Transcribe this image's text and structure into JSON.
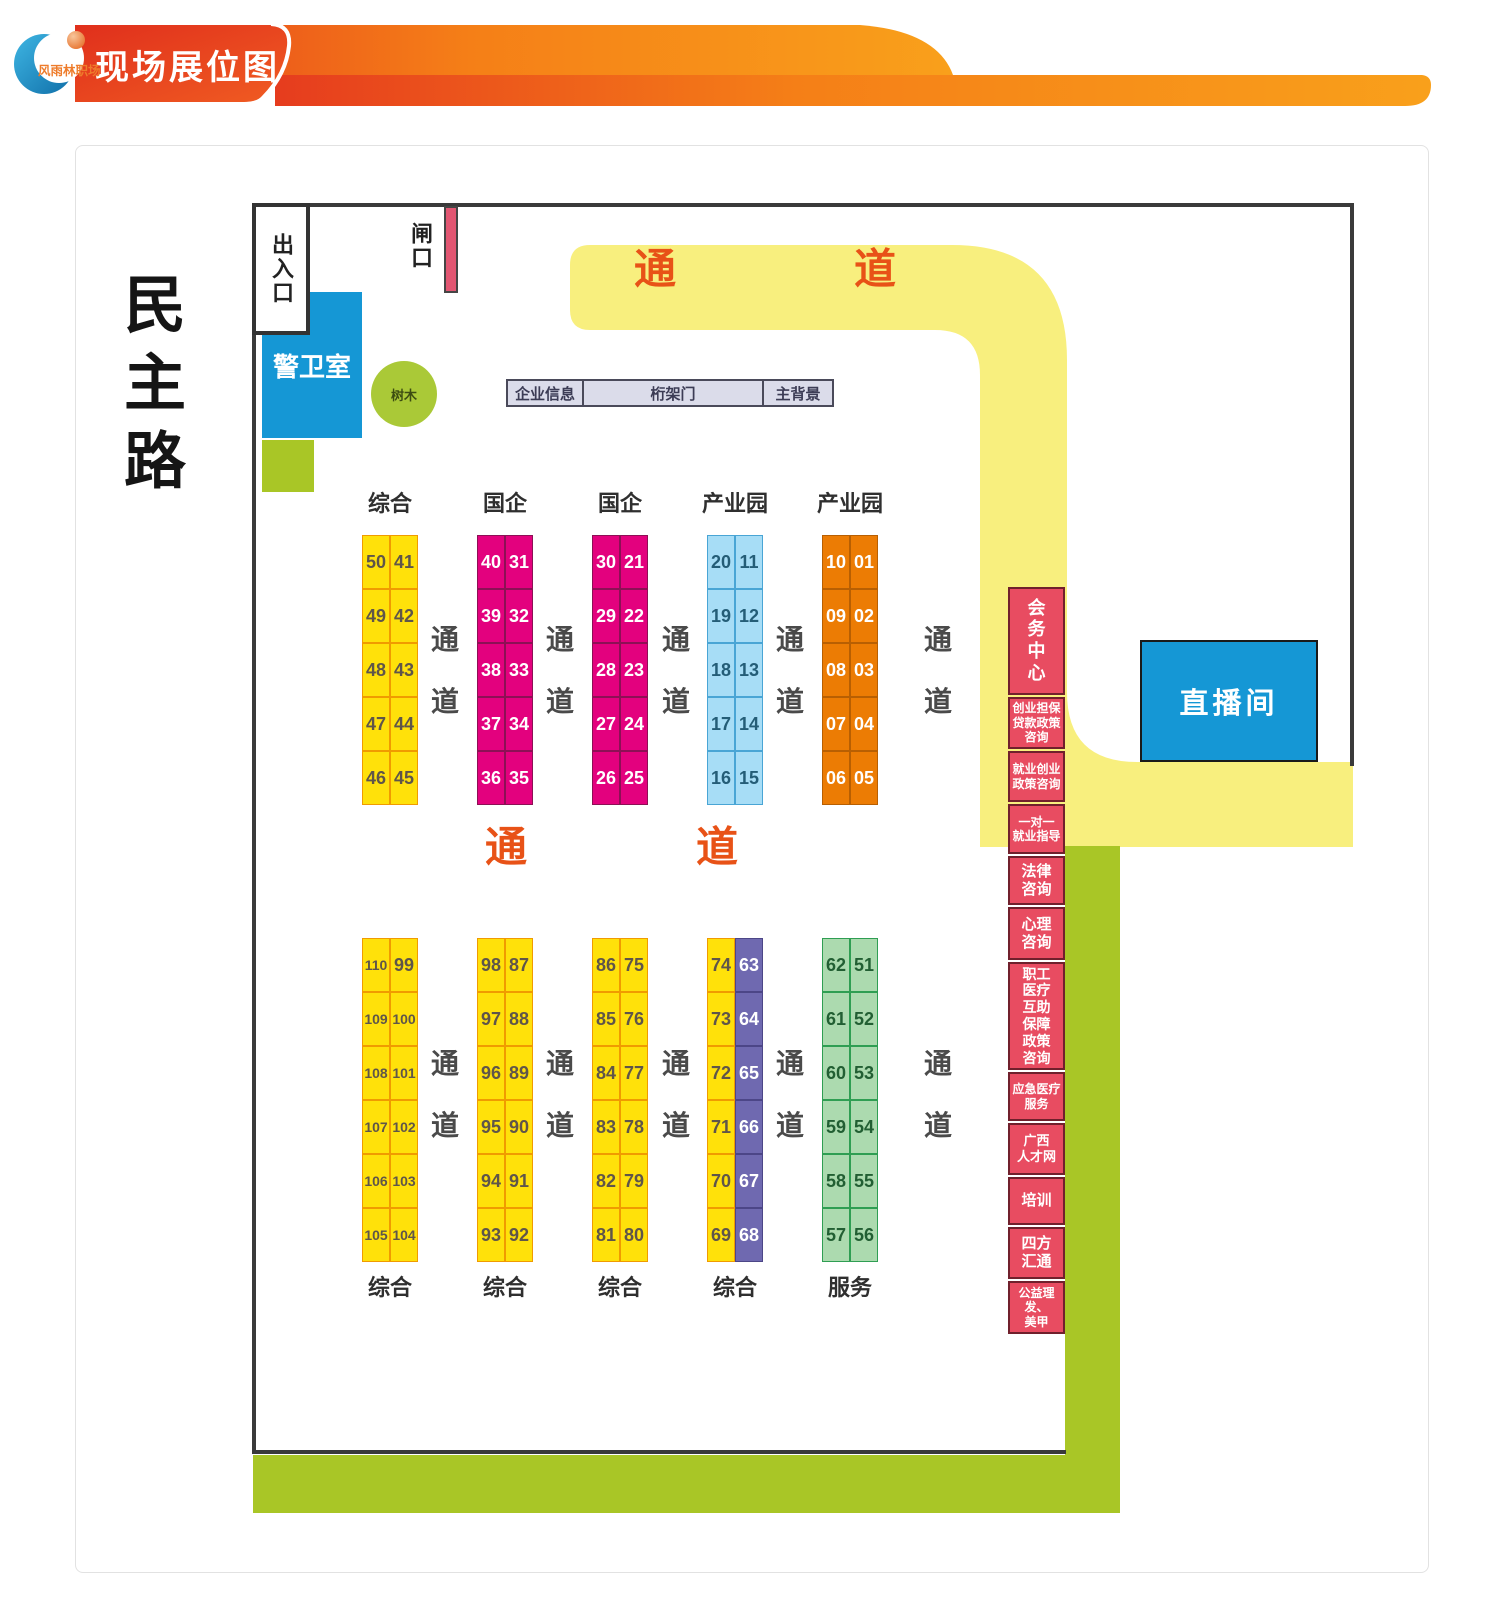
{
  "logo": {
    "text": "风雨林职场"
  },
  "header": {
    "title": "现场展位图"
  },
  "road_label": "民主路",
  "plan": {
    "entrance": "出入口",
    "gate": "闸口",
    "guard_room": "警卫室",
    "tree": "树木",
    "info_bar": [
      "企业信息",
      "桁架门",
      "主背景"
    ],
    "live_room": "直播间",
    "corridor_word": [
      "通",
      "道"
    ]
  },
  "top_section": {
    "groups": [
      {
        "label": "综合",
        "theme": "yellow",
        "left": [
          "50",
          "49",
          "48",
          "47",
          "46"
        ],
        "right": [
          "41",
          "42",
          "43",
          "44",
          "45"
        ]
      },
      {
        "label": "国企",
        "theme": "magenta",
        "left": [
          "40",
          "39",
          "38",
          "37",
          "36"
        ],
        "right": [
          "31",
          "32",
          "33",
          "34",
          "35"
        ]
      },
      {
        "label": "国企",
        "theme": "magenta",
        "left": [
          "30",
          "29",
          "28",
          "27",
          "26"
        ],
        "right": [
          "21",
          "22",
          "23",
          "24",
          "25"
        ]
      },
      {
        "label": "产业园",
        "theme": "blue",
        "left": [
          "20",
          "19",
          "18",
          "17",
          "16"
        ],
        "right": [
          "11",
          "12",
          "13",
          "14",
          "15"
        ]
      },
      {
        "label": "产业园",
        "theme": "orange",
        "left": [
          "10",
          "09",
          "08",
          "07",
          "06"
        ],
        "right": [
          "01",
          "02",
          "03",
          "04",
          "05"
        ]
      }
    ]
  },
  "bottom_section": {
    "groups": [
      {
        "label": "综合",
        "theme": "yellow",
        "left": [
          "110",
          "109",
          "108",
          "107",
          "106",
          "105"
        ],
        "right": [
          "99",
          "100",
          "101",
          "102",
          "103",
          "104"
        ]
      },
      {
        "label": "综合",
        "theme": "yellow",
        "left": [
          "98",
          "97",
          "96",
          "95",
          "94",
          "93"
        ],
        "right": [
          "87",
          "88",
          "89",
          "90",
          "91",
          "92"
        ]
      },
      {
        "label": "综合",
        "theme": "yellow",
        "left": [
          "86",
          "85",
          "84",
          "83",
          "82",
          "81"
        ],
        "right": [
          "75",
          "76",
          "77",
          "78",
          "79",
          "80"
        ]
      },
      {
        "label": "综合",
        "theme": "yellow-purple",
        "left": [
          "74",
          "73",
          "72",
          "71",
          "70",
          "69"
        ],
        "right": [
          "63",
          "64",
          "65",
          "66",
          "67",
          "68"
        ]
      },
      {
        "label": "服务",
        "theme": "green",
        "left": [
          "62",
          "61",
          "60",
          "59",
          "58",
          "57"
        ],
        "right": [
          "51",
          "52",
          "53",
          "54",
          "55",
          "56"
        ]
      }
    ]
  },
  "service_column": {
    "cells": [
      {
        "label": "会\n务\n中\n心",
        "h": 108,
        "fs": 18
      },
      {
        "label": "创业担保\n贷款政策\n咨询",
        "h": 52,
        "fs": 12
      },
      {
        "label": "就业创业\n政策咨询",
        "h": 51,
        "fs": 12
      },
      {
        "label": "一对一\n就业指导",
        "h": 50,
        "fs": 12
      },
      {
        "label": "法律\n咨询",
        "h": 49,
        "fs": 15
      },
      {
        "label": "心理\n咨询",
        "h": 53,
        "fs": 15
      },
      {
        "label": "职工\n医疗\n互助\n保障\n政策\n咨询",
        "h": 108,
        "fs": 14
      },
      {
        "label": "应急医疗\n服务",
        "h": 49,
        "fs": 12
      },
      {
        "label": "广西\n人才网",
        "h": 52,
        "fs": 13
      },
      {
        "label": "培训",
        "h": 48,
        "fs": 15
      },
      {
        "label": "四方\n汇通",
        "h": 52,
        "fs": 15
      },
      {
        "label": "公益理发、\n美甲",
        "h": 53,
        "fs": 12
      }
    ]
  },
  "colors": {
    "banner_red": "#e8391d",
    "banner_orange": "#f9a01b",
    "title_block_red": "#e23318",
    "booth_yellow": "#ffe10a",
    "booth_magenta": "#e3017e",
    "booth_blue": "#a7ddf6",
    "booth_orange": "#ec7c04",
    "booth_purple": "#6f69b0",
    "booth_green": "#acdaaf",
    "service_red": "#e84c61",
    "olive_green": "#a9c626",
    "path_yellow": "#f8ef7e",
    "corridor_text": "#e85217",
    "room_blue": "#1597d5",
    "gate_pink": "#e25672"
  }
}
